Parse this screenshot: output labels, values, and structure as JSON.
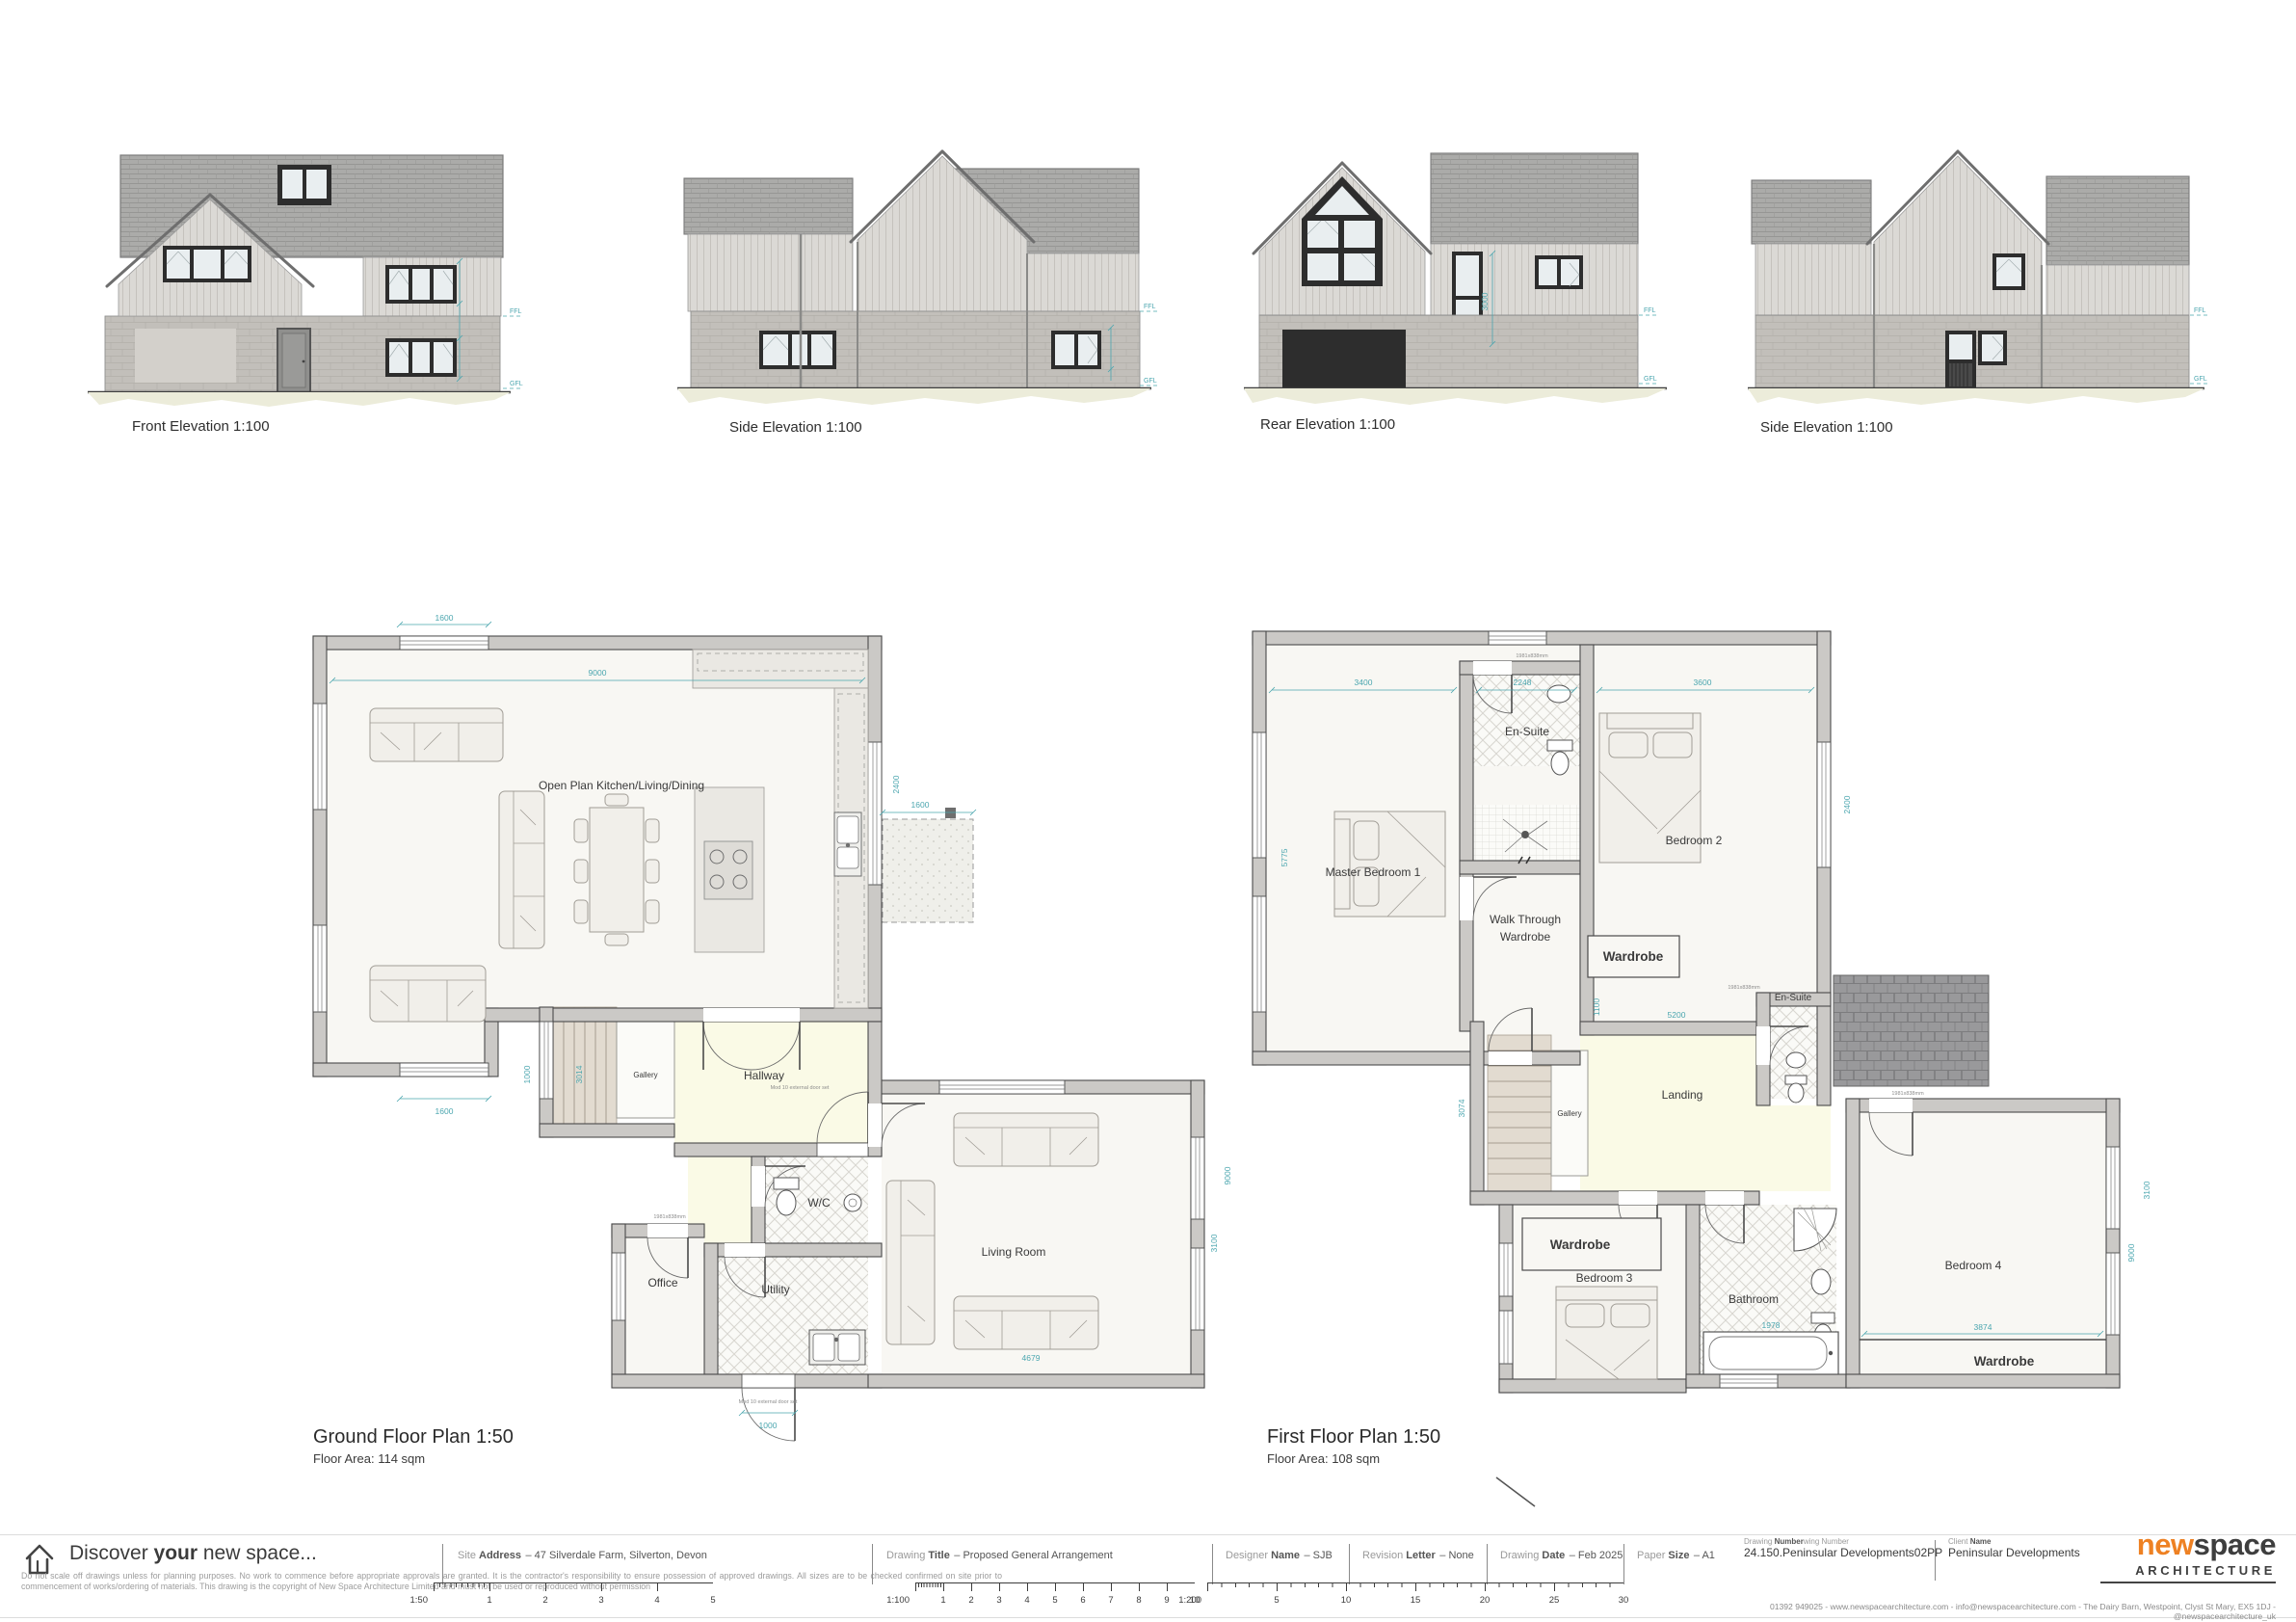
{
  "colors": {
    "accent_orange": "#EE8123",
    "dim_teal": "#4BA6AF"
  },
  "elevations": {
    "labels": [
      "Front Elevation 1:100",
      "Side Elevation 1:100",
      "Rear Elevation 1:100",
      "Side Elevation 1:100"
    ],
    "ffl": "FFL",
    "gfl": "GFL",
    "rear_dim": "3000"
  },
  "ground_floor": {
    "title": "Ground Floor Plan 1:50",
    "area": "Floor Area: 114 sqm",
    "rooms": {
      "open_plan": "Open Plan Kitchen/Living/Dining",
      "hallway": "Hallway",
      "gallery": "Gallery",
      "wc": "W/C",
      "office": "Office",
      "utility": "Utility",
      "living": "Living Room"
    },
    "dims": {
      "win_top": "1600",
      "width": "9000",
      "win_bottom": "1600",
      "patio": "1600",
      "right": "2400",
      "stairs": "3014",
      "stairs_w": "1000",
      "utility_door": "1000",
      "living_bottom": "4679",
      "living_right": "3100",
      "living_height": "9000"
    }
  },
  "first_floor": {
    "title": "First Floor Plan 1:50",
    "area": "Floor Area: 108 sqm",
    "rooms": {
      "master": "Master Bedroom 1",
      "ensuite1": "En-Suite",
      "bed2": "Bedroom 2",
      "wtw_line1": "Walk Through",
      "wtw_line2": "Wardrobe",
      "wardrobe2": "Wardrobe",
      "gallery": "Gallery",
      "landing": "Landing",
      "ensuite2": "En-Suite",
      "wardrobe3": "Wardrobe",
      "bed3": "Bedroom 3",
      "bath": "Bathroom",
      "bed4": "Bedroom 4",
      "wardrobe4": "Wardrobe"
    },
    "dims": {
      "master": "3400",
      "ensuite": "2248",
      "bed2": "3600",
      "bed2_r": "2400",
      "left": "5775",
      "wtw": "1100",
      "landing": "5200",
      "stairs": "3074",
      "bath": "1978",
      "bed4": "3874",
      "right": "9000",
      "right2": "3100"
    }
  },
  "tags": {
    "door_size": "1981x838mm",
    "external_door": "Mod 10 external door set"
  },
  "footer": {
    "tagline": {
      "pre": "Discover ",
      "bold": "your",
      "suf": " new space..."
    },
    "disclaimer": "Do not scale off drawings unless for planning purposes. No work to commence before appropriate approvals are granted. It is the contractor's responsibility to ensure possession of approved drawings. All sizes are to be checked confirmed on site prior to commencement of works/ordering of materials. This drawing is the copyright of New Space Architecture Limited and must not be used or reproduced without permission",
    "fields": {
      "site": {
        "pre": "Site ",
        "bold": "Address",
        "value": "– 47 Silverdale Farm, Silverton, Devon"
      },
      "title": {
        "pre": "Drawing ",
        "bold": "Title",
        "value": "– Proposed General Arrangement"
      },
      "designer": {
        "pre": "Designer ",
        "bold": "Name",
        "value": "– SJB"
      },
      "revision": {
        "pre": "Revision ",
        "bold": "Letter",
        "value": "– None"
      },
      "date": {
        "pre": "Drawing ",
        "bold": "Date",
        "value": "– Feb 2025"
      },
      "paper": {
        "pre": "Paper ",
        "bold": "Size",
        "value": "– A1"
      },
      "number": {
        "pre": "Drawing ",
        "bold": "Number",
        "suf": "wing Number",
        "value": "24.150.Peninsular Developments02PP"
      },
      "client": {
        "pre": "Client ",
        "bold": "Name",
        "value": "Peninsular Developments"
      }
    },
    "scales": {
      "s50": {
        "label": "1:50",
        "ticks": [
          "1",
          "2",
          "3",
          "4",
          "5"
        ]
      },
      "s100": {
        "label": "1:100",
        "ticks": [
          "1",
          "2",
          "3",
          "4",
          "5",
          "6",
          "7",
          "8",
          "9",
          "10"
        ]
      },
      "s200": {
        "label": "1:200",
        "ticks": [
          "5",
          "10",
          "15",
          "20",
          "25",
          "30"
        ]
      }
    },
    "logo": {
      "new": "new",
      "space": "space",
      "arch": "ARCHITECTURE"
    },
    "contact": "01392 949025 - www.newspacearchitecture.com - info@newspacearchitecture.com - The Dairy Barn, Westpoint, Clyst St Mary, EX5 1DJ - @newspacearchitecture_uk"
  }
}
